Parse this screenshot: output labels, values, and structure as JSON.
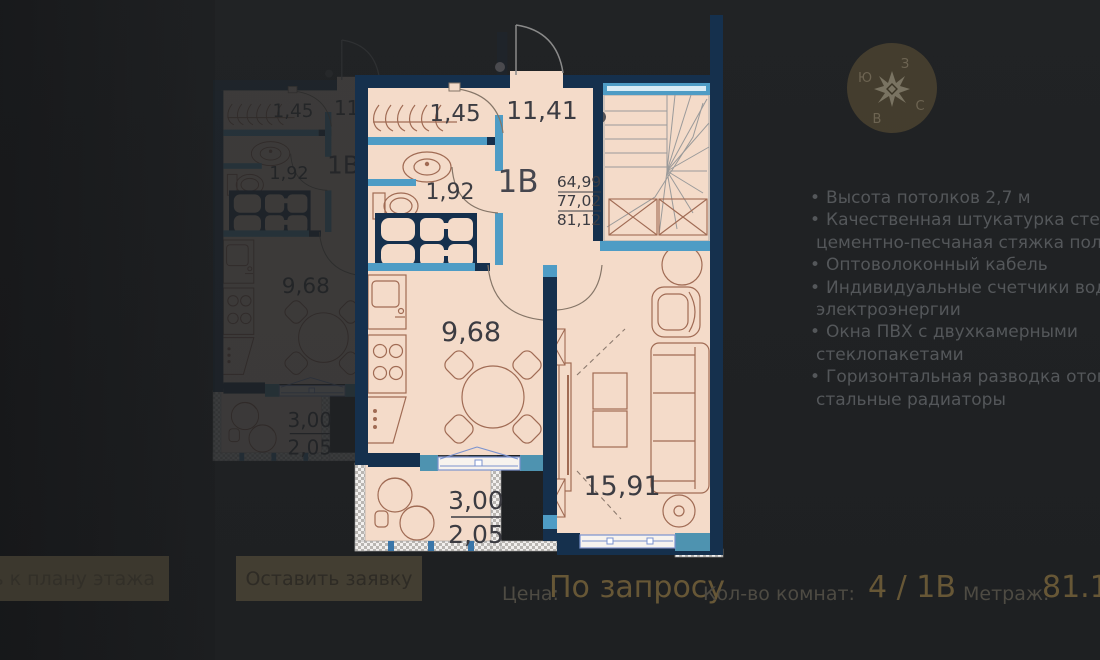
{
  "plan": {
    "rooms": {
      "closet": "1,45",
      "hall": "11,41",
      "type_label": "1В",
      "wc": "1,92",
      "kitchen": "9,68",
      "living": "15,91",
      "balcony_top": "3,00",
      "balcony_bottom": "2,05"
    },
    "areas": {
      "living": "64,99",
      "without_balcony": "77,02",
      "total": "81,12"
    },
    "colors": {
      "wall": "#15304d",
      "partition": "#4e9cc5",
      "teal_block": "#4e93b0",
      "floor": "#f4dbc9",
      "furniture": "#a06b54",
      "window_frame": "#7b93cf",
      "stairs": "#9a9a9a",
      "label": "#3c3c42"
    }
  },
  "compass": {
    "n": "С",
    "s": "Ю",
    "e": "В",
    "w": "З"
  },
  "features": {
    "items": [
      {
        "b": "•",
        "t": "Высота потолков 2,7 м"
      },
      {
        "b": "•",
        "t": "Качественная штукатурка стен и"
      },
      {
        "b": "",
        "t": "цементно-песчаная стяжка полов"
      },
      {
        "b": "•",
        "t": "Оптоволоконный кабель"
      },
      {
        "b": "•",
        "t": "Индивидуальные счетчики воды, те"
      },
      {
        "b": "",
        "t": "электроэнергии"
      },
      {
        "b": "•",
        "t": "Окна ПВХ с двухкамерными"
      },
      {
        "b": "",
        "t": "стеклопакетами"
      },
      {
        "b": "•",
        "t": "Горизонтальная разводка отоплен"
      },
      {
        "b": "",
        "t": "стальные радиаторы"
      }
    ]
  },
  "footer": {
    "price_label": "Цена:",
    "price_value": "По запросу",
    "rooms_label": "Кол-во комнат:",
    "rooms_value": "4 / 1В",
    "area_label": "Метраж:",
    "area_value": "81.12"
  },
  "buttons": {
    "back_to_plan": "ь к плану этажа",
    "request": "Оставить заявку"
  }
}
